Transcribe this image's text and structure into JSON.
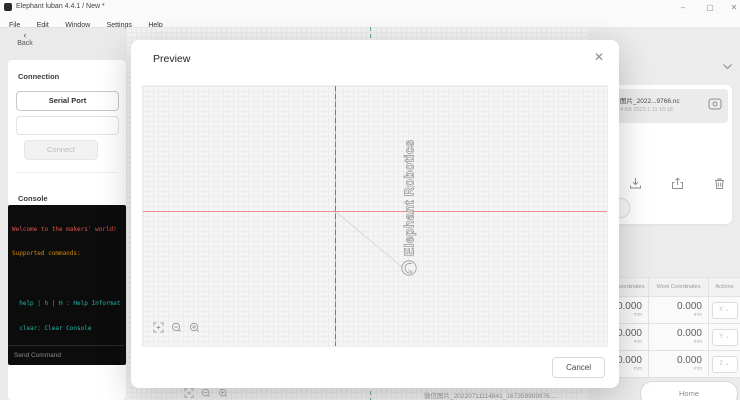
{
  "window": {
    "title": "Elephant luban 4.4.1 / New *",
    "controls": {
      "minimize": "–",
      "maximize": "▢",
      "close": "✕"
    }
  },
  "menu": {
    "items": [
      "File",
      "Edit",
      "Window",
      "Settings",
      "Help"
    ]
  },
  "sidebar": {
    "back_label": "Back",
    "back_chevron": "‹",
    "connection": {
      "title": "Connection",
      "serial_port_label": "Serial Port",
      "port_value": "",
      "connect_label": "Connect"
    },
    "console": {
      "title": "Console",
      "lines": [
        {
          "text": "Welcome to the makers' world!",
          "color": "#e0524e"
        },
        {
          "text": "Supported commands:",
          "color": "#cf8a0b"
        },
        {
          "text": "",
          "color": "#ffffff"
        },
        {
          "text": "  help | h | H : Help Informat",
          "color": "#27b3a4"
        },
        {
          "text": "  clear: Clear Console",
          "color": "#27b3a4"
        },
        {
          "text": "  g | G : G-Command List",
          "color": "#7cbf4a"
        },
        {
          "text": "  m | M : M-Command List",
          "color": "#27b3a4"
        }
      ],
      "input_placeholder": "Send Command"
    }
  },
  "main_canvas": {
    "file_label": "微信图片_20220711114841_167359909976..."
  },
  "modal": {
    "title": "Preview",
    "close_glyph": "✕",
    "cancel_label": "Cancel",
    "engraving_text": "Elephant Robotics"
  },
  "right_panel": {
    "file": {
      "name": "图片_2022...9766.nc",
      "meta": "4 KB   2023.1.11 16:18"
    },
    "device_button_label": "Device",
    "table": {
      "headers": [
        "Machine Coordinates",
        "Work Coordinates",
        "Actions"
      ],
      "rows": [
        {
          "machine": "0.000",
          "machine_unit": "mm",
          "work": "0.000",
          "work_unit": "mm",
          "axis": "X ⌄"
        },
        {
          "machine": "0.000",
          "machine_unit": "mm",
          "work": "0.000",
          "work_unit": "mm",
          "axis": "Y ⌄"
        },
        {
          "machine": "0.000",
          "machine_unit": "mm",
          "work": "0.000",
          "work_unit": "mm",
          "axis": "Z ⌄"
        }
      ]
    },
    "home_label": "Home"
  },
  "colors": {
    "axis_x": "#f0908f",
    "axis_y": "#3a9e5f",
    "engrave_outline": "#9a9a9a",
    "console_bg": "#0c0c0c"
  }
}
